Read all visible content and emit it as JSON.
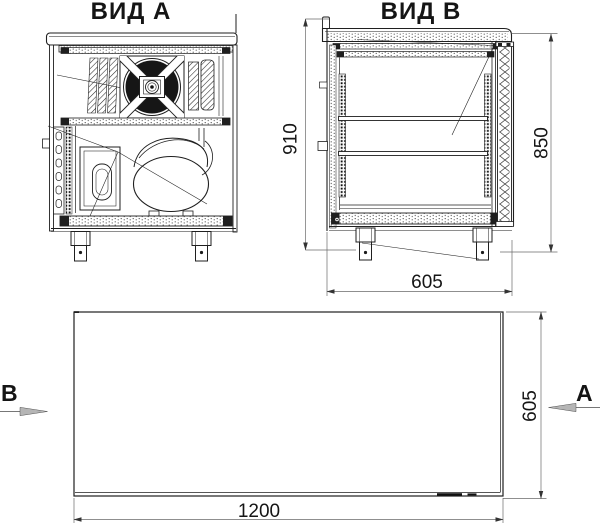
{
  "drawing": {
    "view_a_title": "ВИД А",
    "view_b_title": "ВИД B",
    "section_arrow_a": "A",
    "section_arrow_b": "B"
  },
  "dimensions": {
    "overall_height": "910",
    "body_height": "850",
    "body_depth": "605",
    "plan_width": "1200",
    "plan_depth": "605"
  },
  "colors": {
    "background": "#ffffff",
    "line": "#1f1f1f",
    "dim_line": "#6a6a6a",
    "arrow_fill": "#b5b5b5",
    "text": "#151515"
  }
}
